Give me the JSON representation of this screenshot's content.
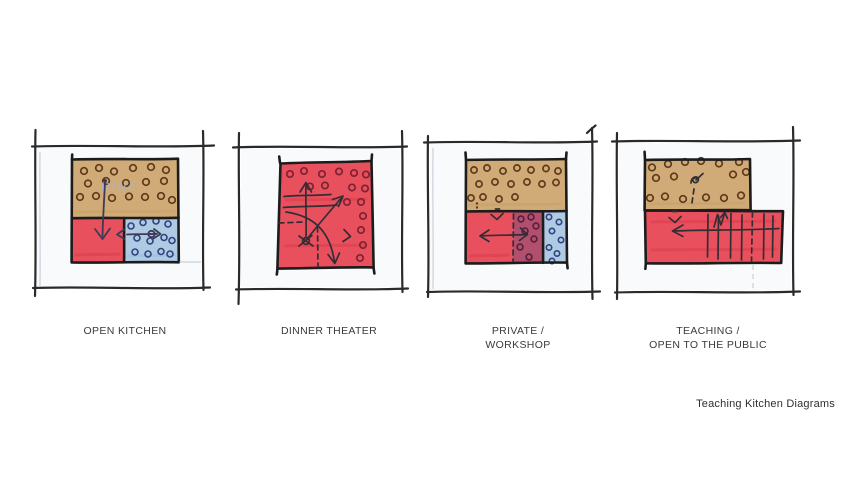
{
  "page": {
    "background": "#ffffff"
  },
  "caption": "Teaching Kitchen Diagrams",
  "colors": {
    "paper": "#ffffff",
    "paper_tint": "#f3f6f8",
    "ink": "#2a2a2a",
    "outline": "#1d1c1c",
    "tan": "#d0ab77",
    "red": "#e9505d",
    "blue": "#aecbe3",
    "purple": "#8e4f77",
    "brown_circle": "#5d3a1a",
    "navy_circle": "#32427f",
    "maroon_circle": "#7c2331",
    "dark_circle": "#55203d",
    "pen_blue": "#3e3a58",
    "pen_black": "#322e35",
    "pencil": "#aab6c6",
    "streak_red": "#c22134",
    "streak_tan": "#b8924f",
    "streak_blue": "#7fa9cc",
    "label_text": "#3a3a3a",
    "caption_text": "#2e2e2e"
  },
  "diagrams": [
    {
      "id": "open-kitchen",
      "label": "OPEN KITCHEN",
      "pencil_note": "DINE"
    },
    {
      "id": "dinner-theater",
      "label": "DINNER THEATER"
    },
    {
      "id": "private-workshop",
      "label": "PRIVATE /\nWORKSHOP"
    },
    {
      "id": "teaching-open-to-public",
      "label": "TEACHING /\nOPEN TO THE PUBLIC"
    }
  ]
}
